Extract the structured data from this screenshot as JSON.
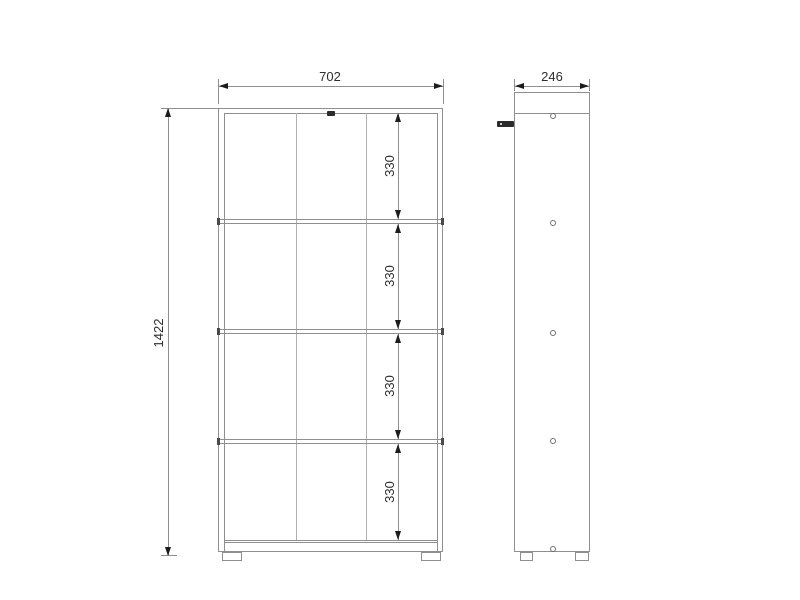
{
  "drawing": {
    "front_view": {
      "width": "702",
      "height": "1422",
      "sections": [
        "330",
        "330",
        "330",
        "330"
      ]
    },
    "side_view": {
      "depth": "246"
    },
    "colors": {
      "outline": "#8f8f8f",
      "thin_line": "#b0b0b0",
      "dimension_text": "#2e2e2e",
      "arrow": "#1c1c1c",
      "hardware": "#2b2b2b",
      "background": "#ffffff"
    }
  }
}
